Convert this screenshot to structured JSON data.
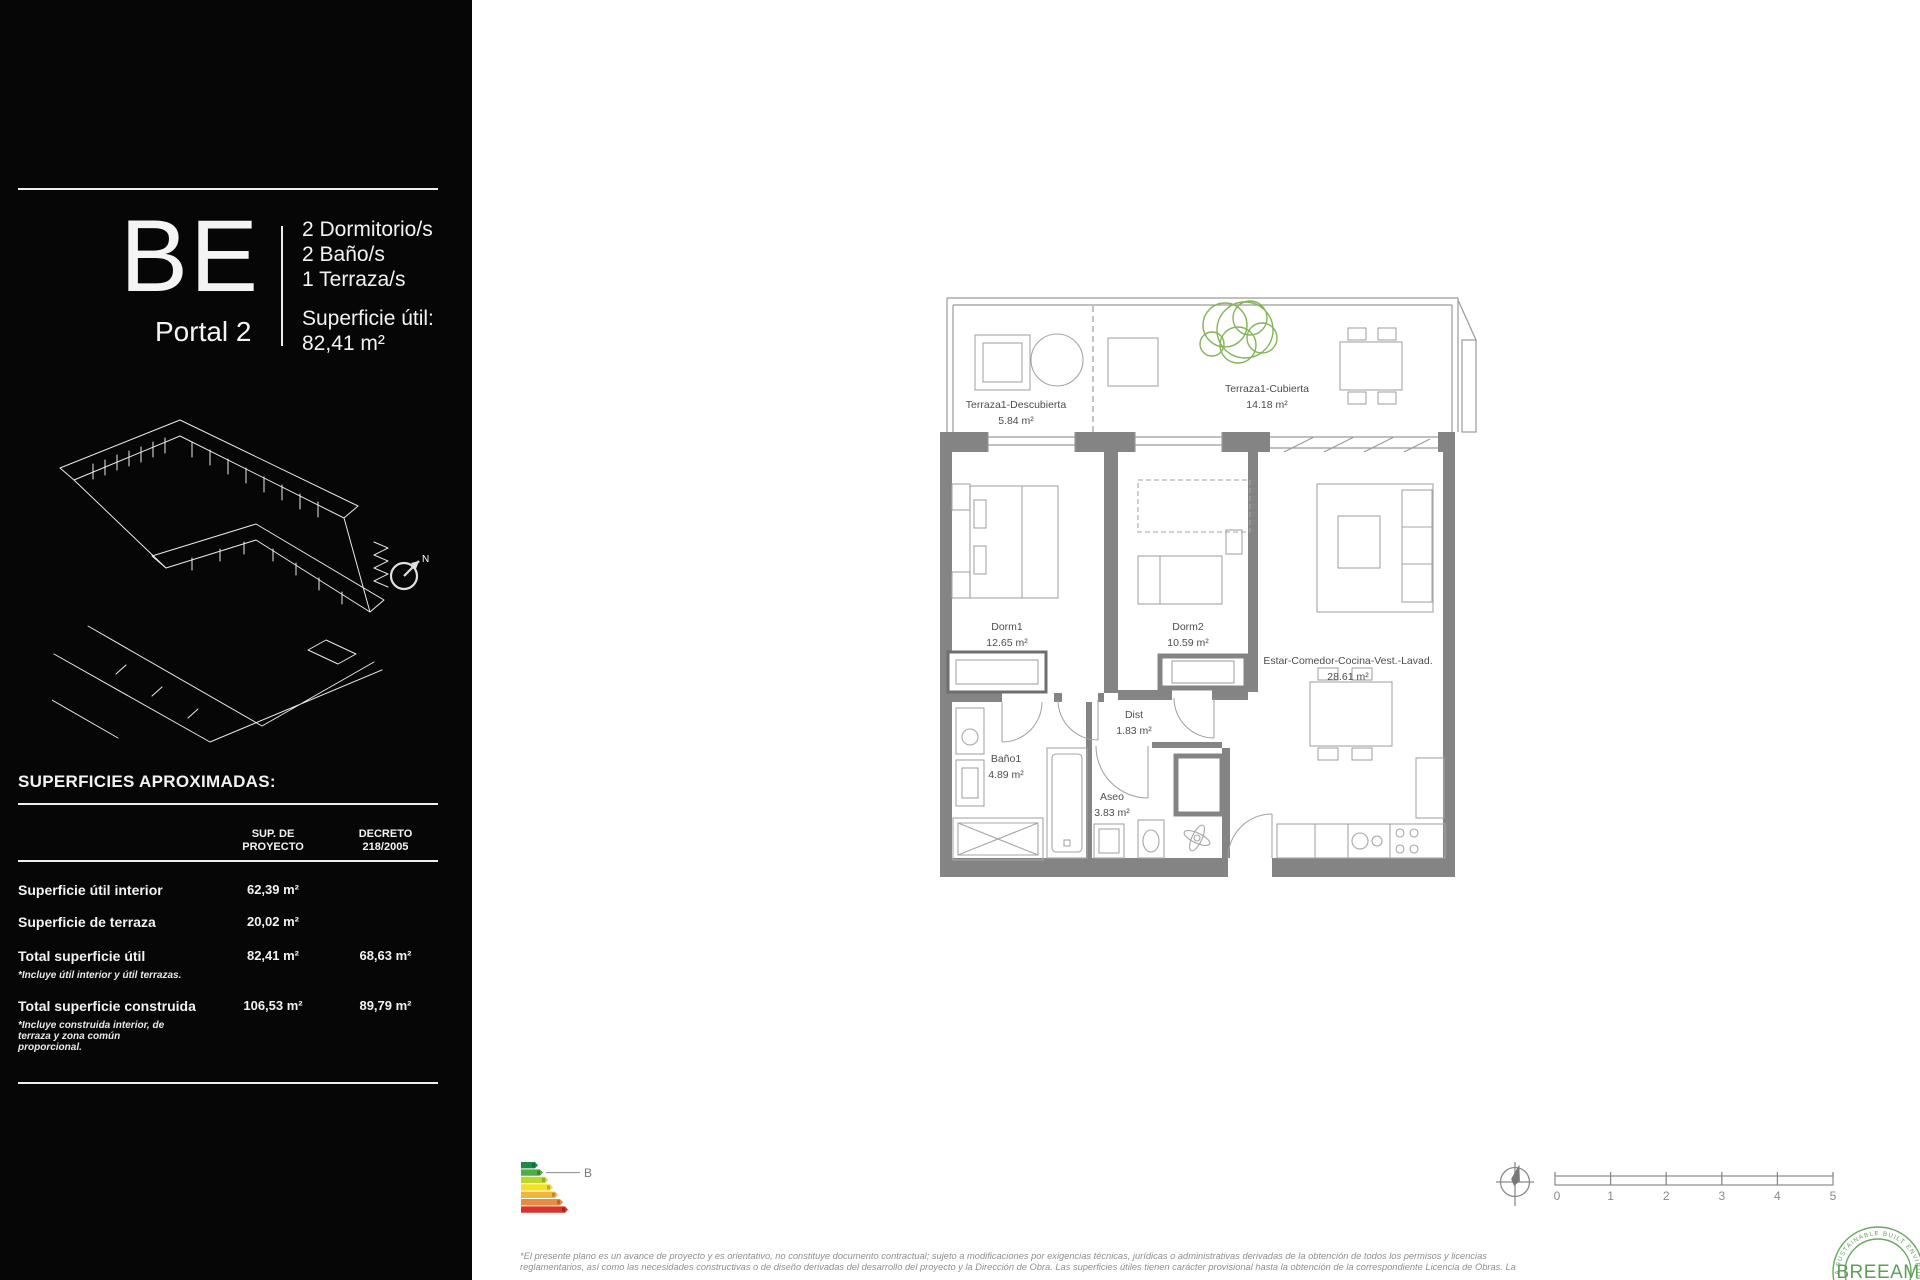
{
  "sidebar": {
    "unit_code": "BE",
    "portal": "Portal 2",
    "features": [
      "2 Dormitorio/s",
      "2 Baño/s",
      "1 Terraza/s"
    ],
    "superficie_util_label": "Superficie útil:",
    "superficie_util_value": "82,41 m²",
    "compass_label": "N",
    "table": {
      "title": "SUPERFICIES APROXIMADAS:",
      "headers": [
        {
          "line1": "SUP. DE",
          "line2": "PROYECTO"
        },
        {
          "line1": "DECRETO",
          "line2": "218/2005"
        }
      ],
      "rows": [
        {
          "label": "Superficie útil interior",
          "proyecto": "62,39 m²"
        },
        {
          "label": "Superficie de terraza",
          "proyecto": "20,02 m²"
        },
        {
          "label": "Total superficie útil",
          "proyecto": "82,41 m²",
          "decreto": "68,63 m²",
          "note": "*Incluye útil interior y útil terrazas."
        },
        {
          "label": "Total superficie construida",
          "proyecto": "106,53 m²",
          "decreto": "89,79 m²",
          "note": "*Incluye construida interior, de terraza y zona común proporcional."
        }
      ]
    }
  },
  "floorplan": {
    "rooms": [
      {
        "name": "Terraza1-Descubierta",
        "area": "5.84 m²"
      },
      {
        "name": "Terraza1-Cubierta",
        "area": "14.18 m²"
      },
      {
        "name": "Dorm1",
        "area": "12.65 m²"
      },
      {
        "name": "Dorm2",
        "area": "10.59 m²"
      },
      {
        "name": "Estar-Comedor-Cocina-Vest.-Lavad.",
        "area": "28.61 m²"
      },
      {
        "name": "Dist",
        "area": "1.83 m²"
      },
      {
        "name": "Baño1",
        "area": "4.89 m²"
      },
      {
        "name": "Aseo",
        "area": "3.83 m²"
      }
    ]
  },
  "energy": {
    "rating": "B",
    "colors": [
      "#1e8b45",
      "#4fae46",
      "#bed630",
      "#f5e028",
      "#f0b440",
      "#eb8b3e",
      "#d9342b"
    ]
  },
  "scalebar": {
    "labels": [
      "0",
      "1",
      "2",
      "3",
      "4",
      "5"
    ]
  },
  "footer": {
    "disclaimer_line1": "*El presente plano es un avance de proyecto y es orientativo, no constituye documento contractual; sujeto a modificaciones por exigencias técnicas, jurídicas o administrativas derivadas de la obtención de todos los permisos y licencias",
    "disclaimer_line2": "reglamentarios, así como las necesidades constructivas o de diseño derivadas del desarrollo del proyecto y la Dirección de Obra. Las superficies útiles tienen carácter provisional hasta la obtención de la correspondiente Licencia de Obras. La"
  },
  "breeam": {
    "title": "BREEAM",
    "arc_text": "A SUSTAINABLE BUILT ENVIRONMENT"
  }
}
